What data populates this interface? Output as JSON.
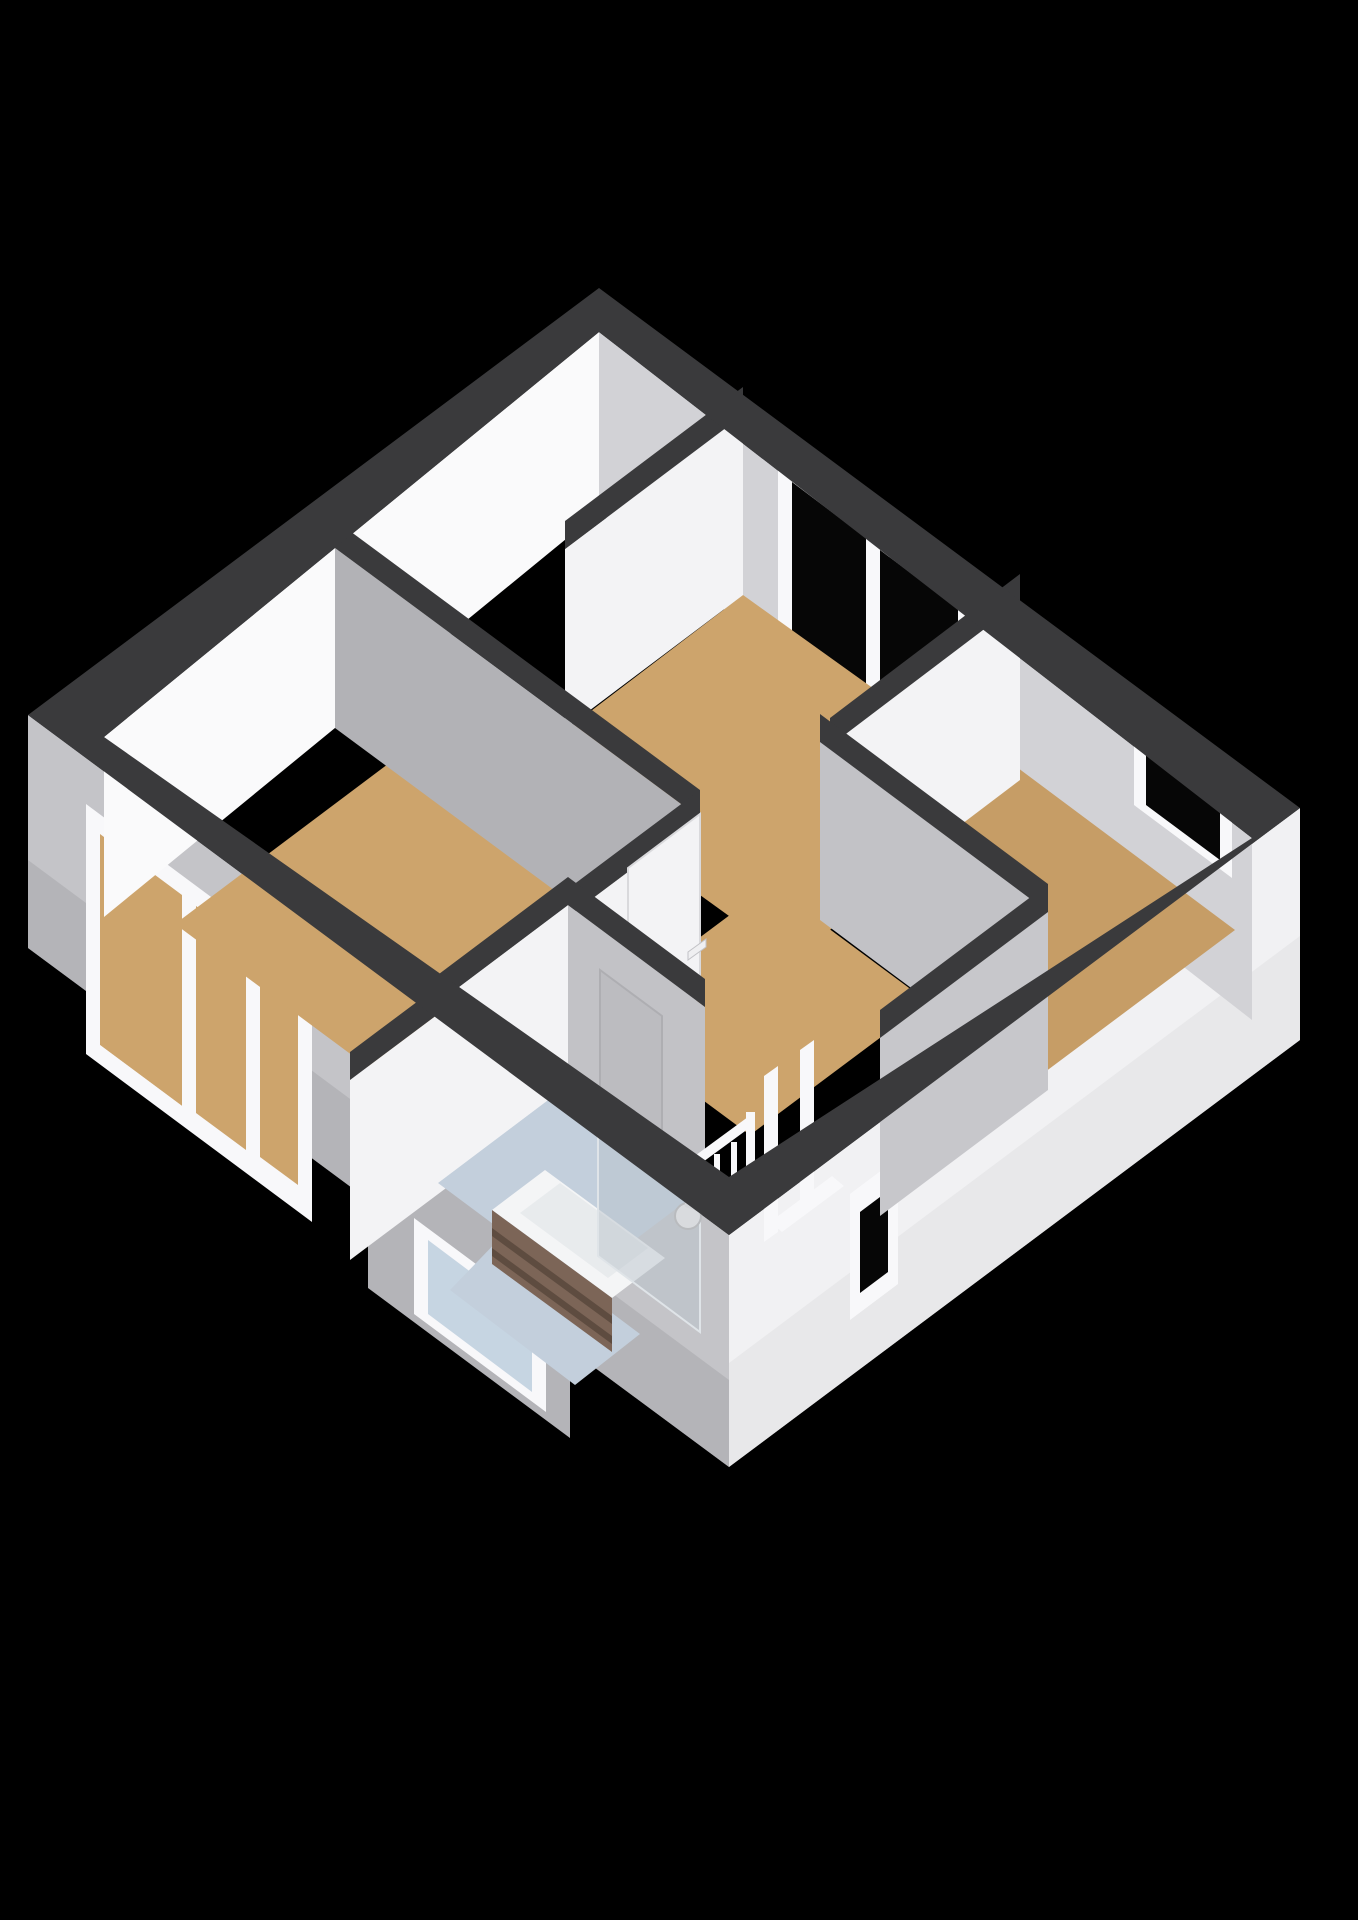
{
  "scene": {
    "type": "3d-floorplan-render",
    "view": "isometric-cutaway-top",
    "rooms": [
      {
        "name": "bedroom-top",
        "floor": "wood-tan"
      },
      {
        "name": "bedroom-right",
        "floor": "wood-tan"
      },
      {
        "name": "bedroom-left",
        "floor": "wood-tan"
      },
      {
        "name": "landing-hallway",
        "floor": "wood-tan"
      },
      {
        "name": "bathroom",
        "floor": "tile-blue"
      }
    ],
    "windows": [
      {
        "name": "top-bedroom-double-window",
        "wall": "north-east",
        "glass": "dark"
      },
      {
        "name": "right-bedroom-window",
        "wall": "north-east",
        "glass": "dark"
      },
      {
        "name": "left-bedroom-triple-window",
        "wall": "south-west",
        "glass": "into-room"
      },
      {
        "name": "bathroom-frosted-window",
        "wall": "south-west-bay",
        "glass": "frosted-blue"
      },
      {
        "name": "stairwell-slit-window",
        "wall": "south-east",
        "glass": "dark"
      }
    ],
    "fixtures": [
      {
        "name": "bathtub-with-wood-panel",
        "room": "bathroom"
      },
      {
        "name": "glass-shower-screen",
        "room": "bathroom"
      },
      {
        "name": "wall-shower-mixer",
        "room": "bathroom"
      },
      {
        "name": "stair-opening-railing",
        "room": "landing-hallway"
      },
      {
        "name": "door-bathroom",
        "room": "bathroom"
      },
      {
        "name": "door-hallway",
        "room": "landing-hallway"
      }
    ]
  },
  "colors": {
    "bg": "#000000",
    "wallTop": "#3a3a3c",
    "nwFace": "#fafafb",
    "neFace": "#d2d2d6",
    "litFace": "#f3f3f5",
    "shadowFaceA": "#b2b2b6",
    "shadowFaceB": "#c2c2c6",
    "shadowFaceC": "#c7c7cb",
    "floorTan": "#cda46c",
    "floorTanDark": "#c69d66",
    "bathFloor": "#c3cfdc",
    "swFacade": "#c4c4c8",
    "swFacadeDark": "#a7a7ab",
    "bayFacade": "#b4b4b8",
    "seFacade": "#f1f1f3",
    "seFacadeDark": "#e2e2e5",
    "glassDark": "#060606",
    "glassFrost": "#c6d5e2",
    "frameWhite": "#f8f8fa",
    "woodPanel": "#7c6557",
    "woodPanelDark": "#5e4c40",
    "tubWhite": "#f4f5f6",
    "tubInner": "#e8ebed",
    "screenGlass": "rgba(186,196,204,0.50)",
    "doorPanel": "#bcbcc0",
    "handleWhite": "#efeff1"
  }
}
